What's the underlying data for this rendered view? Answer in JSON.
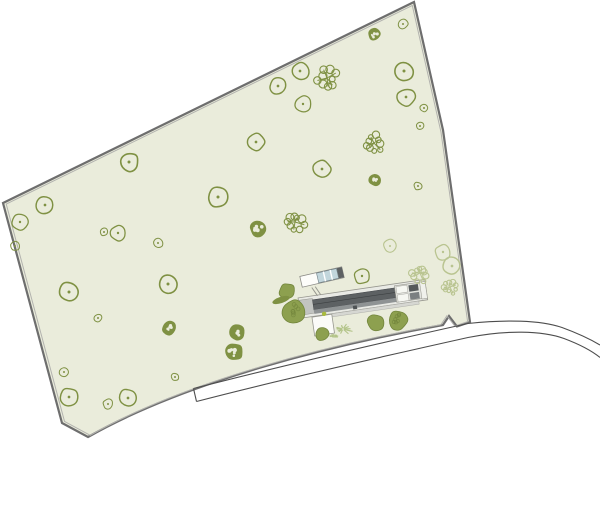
{
  "canvas": {
    "width": 600,
    "height": 520,
    "background": "#ffffff"
  },
  "colors": {
    "parcel_fill": "#eaecdb",
    "boundary_outer": "#6e6e6e",
    "boundary_inner": "#b2b2ae",
    "tree_outline": "#7f9143",
    "tree_light": "#b9c490",
    "tree_solid": "#8da04f",
    "tree_solid_dark": "#72853c",
    "spiky": "#b3c489",
    "road_line": "#4d4d4d",
    "roof_dark": "#5d6163",
    "roof_mid": "#8f9394",
    "building_light": "#e9eae5",
    "building_outline": "#97978f",
    "glass": "#c2d6dc",
    "accent_dot": "#a9bb3e",
    "white": "#ffffff"
  },
  "parcel": {
    "outer_path": "M 3,203 L 414,2 L 443,130 L 470,322 L 457,326.5 L 449,316 L 443,325 C 330,345 185,382 88,437 L 62,423 Z",
    "inner_scale": 0.988,
    "inner_cx": 272,
    "inner_cy": 292,
    "outer_width": 2.2,
    "inner_width": 1
  },
  "road": {
    "top_path": "M 193.5,388.5 C 270,369 380,343 468,323.5 C 505,319.5 540,320 562,327.5 C 577,333 590,339 600,345",
    "bottom_path": "M 196.5,401.5 C 275,381 385,356 468,337.5 C 505,330 542,330.5 564,338.5 C 580,344.5 592,351 600,357.5",
    "cap_path": "M 193.5,388.5 L 196.5,401.5",
    "width": 1.1
  },
  "trees": [
    {
      "type": "ring",
      "x": 278,
      "y": 86,
      "r": 9
    },
    {
      "type": "ring",
      "x": 300,
      "y": 71,
      "r": 9
    },
    {
      "type": "ring",
      "x": 303,
      "y": 104,
      "r": 8
    },
    {
      "type": "ring",
      "x": 403,
      "y": 24,
      "r": 5
    },
    {
      "type": "ring",
      "x": 404,
      "y": 71,
      "r": 10
    },
    {
      "type": "ring",
      "x": 406,
      "y": 97,
      "r": 9
    },
    {
      "type": "ring",
      "x": 424,
      "y": 108,
      "r": 4
    },
    {
      "type": "ring",
      "x": 420,
      "y": 126,
      "r": 4
    },
    {
      "type": "ring",
      "x": 129,
      "y": 162,
      "r": 10
    },
    {
      "type": "ring",
      "x": 256,
      "y": 142,
      "r": 9
    },
    {
      "type": "ring",
      "x": 218,
      "y": 197,
      "r": 10
    },
    {
      "type": "ring",
      "x": 45,
      "y": 205,
      "r": 9
    },
    {
      "type": "ring",
      "x": 20,
      "y": 222,
      "r": 8
    },
    {
      "type": "ring",
      "x": 118,
      "y": 233,
      "r": 8
    },
    {
      "type": "ring",
      "x": 104,
      "y": 232,
      "r": 4
    },
    {
      "type": "ring",
      "x": 158,
      "y": 243,
      "r": 5
    },
    {
      "type": "ring",
      "x": 15,
      "y": 246,
      "r": 5
    },
    {
      "type": "ring",
      "x": 322,
      "y": 169,
      "r": 9
    },
    {
      "type": "ring",
      "x": 418,
      "y": 186,
      "r": 4
    },
    {
      "type": "ring",
      "x": 362,
      "y": 276,
      "r": 8
    },
    {
      "type": "ring",
      "x": 69,
      "y": 292,
      "r": 10
    },
    {
      "type": "ring",
      "x": 168,
      "y": 284,
      "r": 10
    },
    {
      "type": "ring",
      "x": 98,
      "y": 318,
      "r": 4
    },
    {
      "type": "ring",
      "x": 64,
      "y": 372,
      "r": 5
    },
    {
      "type": "ring",
      "x": 175,
      "y": 377,
      "r": 4
    },
    {
      "type": "ring",
      "x": 69,
      "y": 397,
      "r": 9
    },
    {
      "type": "ring",
      "x": 108,
      "y": 404,
      "r": 5
    },
    {
      "type": "ring",
      "x": 128,
      "y": 398,
      "r": 9
    },
    {
      "type": "ring-light",
      "x": 390,
      "y": 246,
      "r": 7
    },
    {
      "type": "ring-light",
      "x": 443,
      "y": 252,
      "r": 8
    },
    {
      "type": "ring-light",
      "x": 452,
      "y": 266,
      "r": 9
    },
    {
      "type": "speckle",
      "x": 374,
      "y": 34,
      "r": 6
    },
    {
      "type": "speckle",
      "x": 375,
      "y": 180,
      "r": 6
    },
    {
      "type": "speckle",
      "x": 258,
      "y": 229,
      "r": 8
    },
    {
      "type": "speckle",
      "x": 169,
      "y": 328,
      "r": 7
    },
    {
      "type": "speckle",
      "x": 237,
      "y": 333,
      "r": 8
    },
    {
      "type": "speckle",
      "x": 234,
      "y": 352,
      "r": 9
    },
    {
      "type": "coral",
      "x": 327,
      "y": 78,
      "r": 13
    },
    {
      "type": "coral",
      "x": 374,
      "y": 143,
      "r": 11
    },
    {
      "type": "coral",
      "x": 295,
      "y": 222,
      "r": 13
    },
    {
      "type": "coral-light",
      "x": 420,
      "y": 273,
      "r": 11
    },
    {
      "type": "coral-light",
      "x": 450,
      "y": 287,
      "r": 9
    },
    {
      "type": "solid",
      "x": 287,
      "y": 291,
      "r": 8
    },
    {
      "type": "solid-textured",
      "x": 294,
      "y": 311,
      "r": 12
    },
    {
      "type": "solid",
      "x": 322,
      "y": 334,
      "r": 7
    },
    {
      "type": "solid",
      "x": 376,
      "y": 323,
      "r": 9
    },
    {
      "type": "solid-textured",
      "x": 398,
      "y": 320,
      "r": 10
    }
  ],
  "accents": [
    {
      "type": "leaf",
      "x": 281,
      "y": 300,
      "rx": 9,
      "ry": 3.2,
      "rot": -18
    },
    {
      "type": "spiky",
      "x": 343,
      "y": 329,
      "r": 11
    },
    {
      "type": "spiky",
      "x": 334,
      "y": 336,
      "r": 5
    }
  ],
  "building": {
    "rotate": -8.3,
    "cx": 360,
    "cy": 300,
    "parts": [
      {
        "t": "rect",
        "x": 299,
        "y": 289,
        "w": 128,
        "h": 20.5,
        "f": "#e9eae5",
        "s": "#97978f",
        "sw": 0.8
      },
      {
        "t": "rect",
        "x": 300,
        "y": 291.5,
        "w": 13,
        "h": 15,
        "f": "#c2c4c1",
        "s": "#97978f",
        "sw": 0.5
      },
      {
        "t": "rect",
        "x": 313,
        "y": 293,
        "w": 83,
        "h": 10,
        "f": "#5d6163",
        "s": "#43464a",
        "sw": 0.5
      },
      {
        "t": "rect",
        "x": 313,
        "y": 303,
        "w": 83,
        "h": 4.2,
        "f": "#8f9394"
      },
      {
        "t": "line",
        "x1": 313,
        "y1": 297.6,
        "x2": 396,
        "y2": 297.6,
        "s": "#3d4042",
        "sw": 0.6
      },
      {
        "t": "rect",
        "x": 396,
        "y": 291,
        "w": 26,
        "h": 16.5,
        "f": "#e2e3de",
        "s": "#97978f",
        "sw": 0.6
      },
      {
        "t": "rect",
        "x": 397.5,
        "y": 292,
        "w": 11,
        "h": 7,
        "f": "#f6f7f2",
        "s": "#a8a8a2",
        "sw": 0.5
      },
      {
        "t": "rect",
        "x": 397.5,
        "y": 300.5,
        "w": 11,
        "h": 7,
        "f": "#f6f7f2",
        "s": "#a8a8a2",
        "sw": 0.5
      },
      {
        "t": "rect",
        "x": 410,
        "y": 292.5,
        "w": 9.5,
        "h": 6.5,
        "f": "#54585a"
      },
      {
        "t": "rect",
        "x": 410,
        "y": 300.5,
        "w": 9.5,
        "h": 6.5,
        "f": "#7b7f81"
      },
      {
        "t": "rect",
        "x": 421.5,
        "y": 291,
        "w": 5.5,
        "h": 17,
        "f": "#f0f1ec",
        "s": "#97978f",
        "sw": 0.5
      },
      {
        "t": "rect",
        "x": 329,
        "y": 309.5,
        "w": 89,
        "h": 3.2,
        "f": "#d6d7d2",
        "s": "#a5a5a0",
        "sw": 0.4
      },
      {
        "t": "rect",
        "x": 310,
        "y": 310,
        "w": 20,
        "h": 19,
        "f": "#fbfbf8",
        "s": "#97978f",
        "sw": 0.8
      },
      {
        "t": "rect",
        "x": 352,
        "y": 304.8,
        "w": 4,
        "h": 3.6,
        "f": "#4e5254"
      },
      {
        "t": "circle",
        "x": 322.5,
        "y": 308.5,
        "r": 2.2,
        "f": "#a9bb3e"
      }
    ]
  },
  "annex": {
    "rotate": -13,
    "cx": 322,
    "cy": 277,
    "parts": [
      {
        "t": "rect",
        "x": 300.5,
        "y": 271.5,
        "w": 43,
        "h": 11,
        "f": "#fdfdfa",
        "s": "#8b8b86",
        "sw": 0.8
      },
      {
        "t": "rect",
        "x": 317.5,
        "y": 272,
        "w": 20.5,
        "h": 10,
        "f": "#c2d6dc",
        "s": "#6f7f85",
        "sw": 0.6
      },
      {
        "t": "line",
        "x1": 324.5,
        "y1": 272,
        "x2": 324.5,
        "y2": 282,
        "s": "#ffffff",
        "sw": 1.4
      },
      {
        "t": "line",
        "x1": 331.5,
        "y1": 272,
        "x2": 331.5,
        "y2": 282,
        "s": "#ffffff",
        "sw": 1.4
      },
      {
        "t": "rect",
        "x": 338.2,
        "y": 271.8,
        "w": 5.3,
        "h": 10.4,
        "f": "#5d6163"
      }
    ]
  },
  "connector": [
    {
      "x1": 311.8,
      "y1": 287.5,
      "x2": 317.5,
      "y2": 295.8
    },
    {
      "x1": 315.2,
      "y1": 286.6,
      "x2": 320.8,
      "y2": 294.9
    }
  ]
}
